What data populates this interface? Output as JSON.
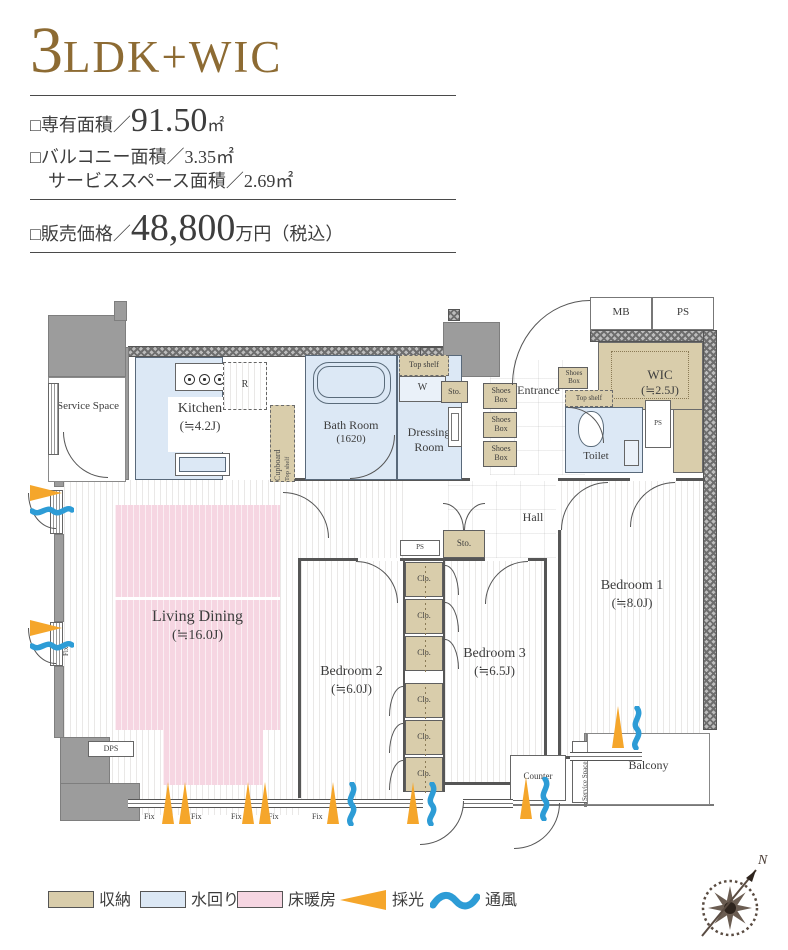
{
  "header": {
    "title_num": "3",
    "title_suffix": "LDK+WIC",
    "area_label": "□専有面積／",
    "area_value": "91.50",
    "area_unit": "㎡",
    "balcony_line": "□バルコニー面積／3.35㎡",
    "service_line": "サービススペース面積／2.69㎡",
    "price_label": "□販売価格／",
    "price_value": "48,800",
    "price_unit": "万円（税込）"
  },
  "plan": {
    "labels": {
      "service_space": "Service Space",
      "kitchen_name": "Kitchen",
      "kitchen_size": "(≒4.2J)",
      "fridge": "R",
      "cupboard_line1": "Cupboard",
      "cupboard_line2": "Top shelf",
      "bath_name": "Bath Room",
      "bath_size": "(1620)",
      "dressing_line1": "Dressing",
      "dressing_line2": "Room",
      "top_shelf": "Top shelf",
      "washer": "W",
      "sto": "Sto.",
      "shoes_box": "Shoes Box",
      "entrance": "Entrance",
      "mb": "MB",
      "ps": "PS",
      "toilet": "Toilet",
      "wic_name": "WIC",
      "wic_size": "(≒2.5J)",
      "hall": "Hall",
      "living_name": "Living Dining",
      "living_size": "(≒16.0J)",
      "bedroom1_name": "Bedroom 1",
      "bedroom1_size": "(≒8.0J)",
      "bedroom2_name": "Bedroom 2",
      "bedroom2_size": "(≒6.0J)",
      "bedroom3_name": "Bedroom 3",
      "bedroom3_size": "(≒6.5J)",
      "closet": "Clo.",
      "counter": "Counter",
      "balcony": "Balcony",
      "dps": "DPS",
      "fix": "Fix",
      "compass_north": "N"
    }
  },
  "legend": {
    "storage": "収納",
    "water": "水回り",
    "heating": "床暖房",
    "daylight": "採光",
    "ventilation": "通風"
  },
  "colors": {
    "accent_brown": "#8d6b33",
    "storage_tan": "#d9cdab",
    "water_blue": "#dce8f5",
    "heating_pink": "#f6d6e2",
    "daylight_orange": "#f5a62b",
    "ventilation_blue": "#2d9cd6"
  }
}
